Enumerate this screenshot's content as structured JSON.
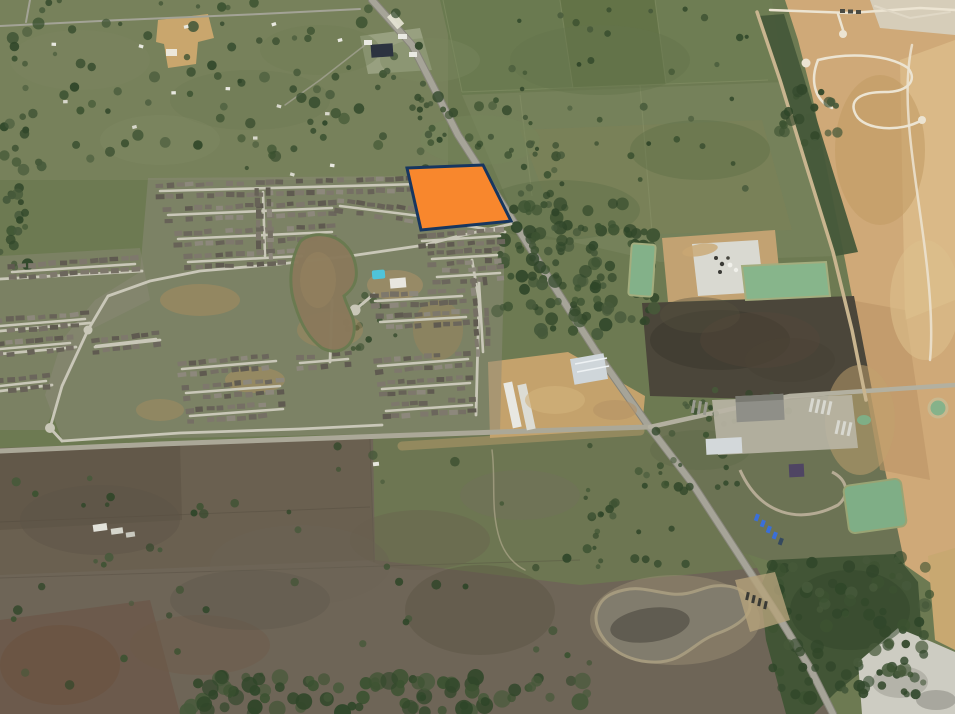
{
  "map": {
    "type": "satellite-aerial",
    "description": "Oblique aerial satellite photograph of a semi-rural area: a dense residential subdivision with a muddy amenity lake on the left, farm fields and pastures, a diagonal two-lane highway, graded tan development land on the right edge, industrial yards with green retention ponds, a dry stock pond at bottom center, and a vacant parcel highlighted orange with a navy outline beside the highway.",
    "highlighted_parcel": {
      "shape": "quadrilateral",
      "points": "407,168 483,165 511,221 421,230",
      "fill": "#F8872D",
      "stroke": "#17365F",
      "stroke_width": 3,
      "label": "Subject parcel"
    },
    "features": [
      {
        "name": "main-highway",
        "kind": "road",
        "description": "Two-lane highway running diagonally from top center to bottom right"
      },
      {
        "name": "cross-road",
        "kind": "road",
        "description": "East-west farm road across the middle of the image"
      },
      {
        "name": "residential-subdivision",
        "kind": "neighborhood",
        "description": "Master-planned subdivision with curving streets and gray rooftops west of the highway"
      },
      {
        "name": "subdivision-lake",
        "kind": "water",
        "description": "Muddy kidney-shaped amenity lake inside the subdivision"
      },
      {
        "name": "community-pool",
        "kind": "amenity",
        "color": "#4FC3D9"
      },
      {
        "name": "graded-development",
        "kind": "construction",
        "description": "Tan graded land with fresh white streets along the right edge"
      },
      {
        "name": "concrete-plant",
        "kind": "industrial",
        "description": "Light concrete batch plant pad with two green retention ponds, center right"
      },
      {
        "name": "equipment-yard",
        "kind": "industrial",
        "description": "Warehouse and trailer yard with a green pond, lower right of center"
      },
      {
        "name": "dark-tilled-field",
        "kind": "field",
        "description": "Dark brown tilled field east of the highway"
      },
      {
        "name": "dry-stock-pond",
        "kind": "water",
        "description": "Dry muddy stock pond at bottom center"
      },
      {
        "name": "pasture",
        "kind": "field",
        "description": "Brown-gray open pasture covering the bottom left"
      },
      {
        "name": "bottom-tree-line",
        "kind": "vegetation",
        "description": "Dark tree line along the bottom edge"
      },
      {
        "name": "bottom-right-forest",
        "kind": "vegetation",
        "description": "Dense forest block in the bottom right"
      },
      {
        "name": "quarry-white-area",
        "kind": "industrial",
        "description": "White industrial/quarry patch in the extreme bottom-right corner"
      }
    ],
    "palette": {
      "field_green": "#6E7C52",
      "pasture_brown": "#6F6557",
      "dirt_tan": "#CFA978",
      "road_gray": "#A6A498",
      "forest_green": "#3C5231",
      "pond_green": "#84B287",
      "lake_mud": "#8A795B",
      "pool_blue": "#4FC3D9",
      "parcel_orange": "#F8872D",
      "parcel_border": "#17365F"
    }
  }
}
